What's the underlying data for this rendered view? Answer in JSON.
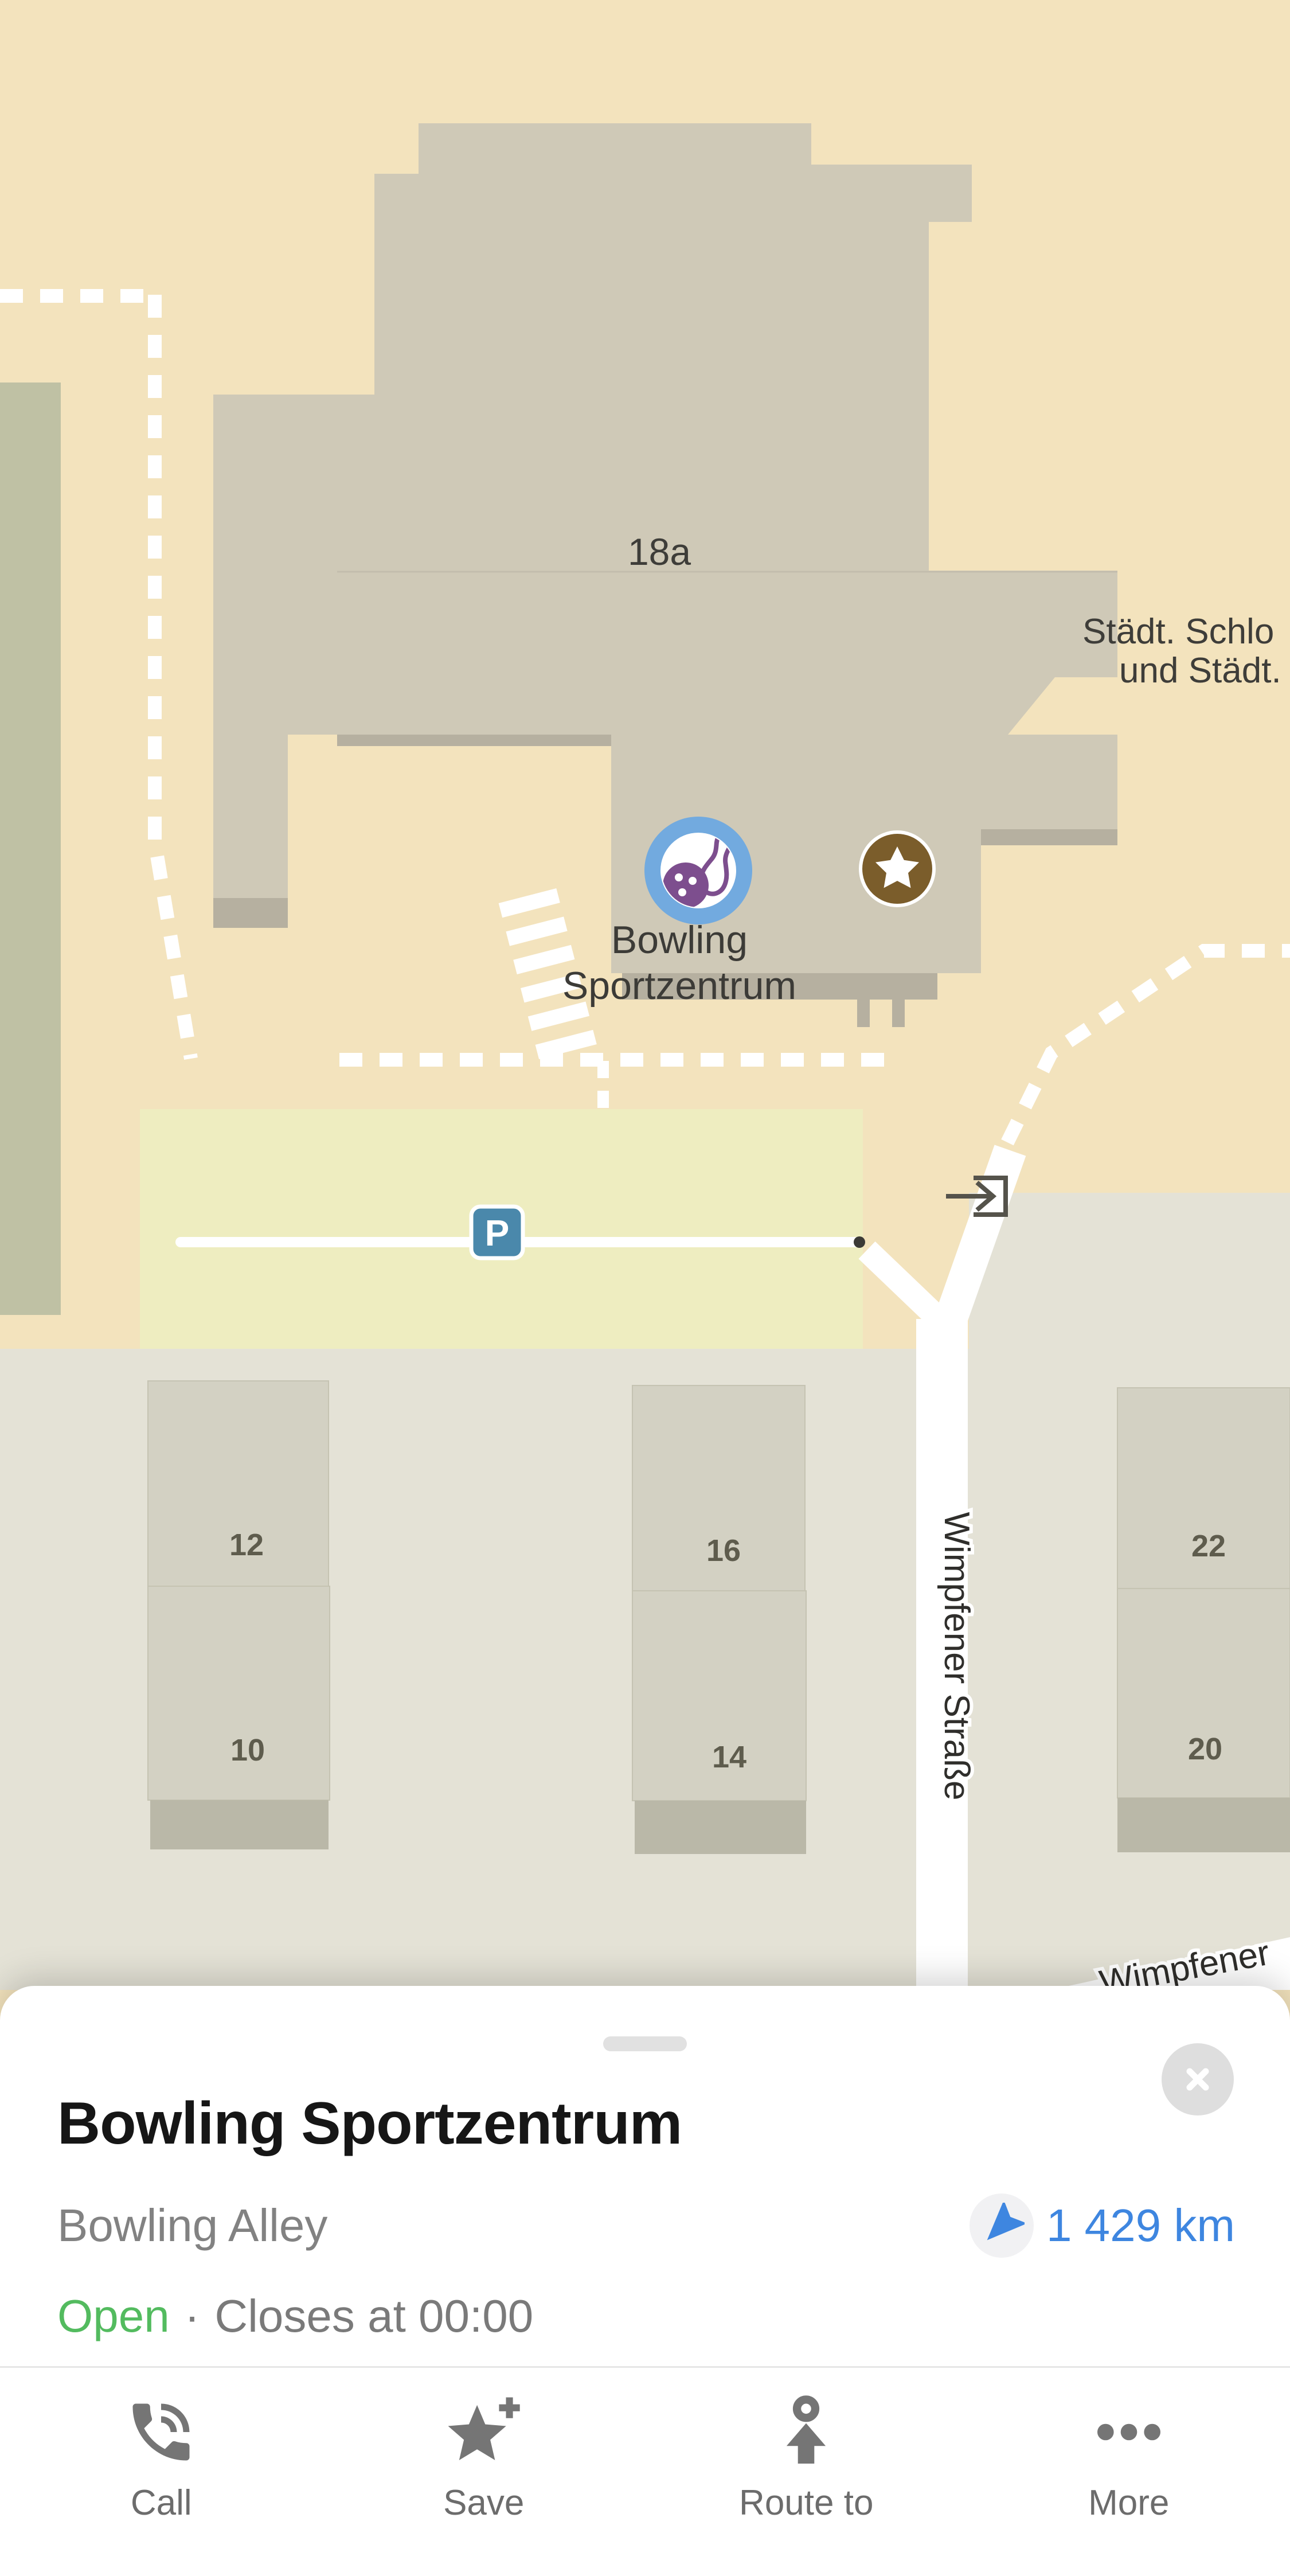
{
  "map": {
    "labels": {
      "building_number": "18a",
      "cut_line1": "Städt. Schlo",
      "cut_line2": "und Städt.",
      "poi_line1": "Bowling",
      "poi_line2": "Sportzentrum",
      "street_vertical": "Wimpfener Straße",
      "street_bottom": "Wimpfener",
      "parking": "P",
      "houses": [
        "12",
        "10",
        "16",
        "14",
        "22",
        "20"
      ]
    }
  },
  "sheet": {
    "title": "Bowling Sportzentrum",
    "category": "Bowling Alley",
    "distance": "1 429 km",
    "status_open": "Open",
    "status_separator": "·",
    "status_closes": "Closes at 00:00",
    "actions": [
      {
        "label": "Call"
      },
      {
        "label": "Save"
      },
      {
        "label": "Route to"
      },
      {
        "label": "More"
      }
    ]
  },
  "colors": {
    "map_land": "#F3E3BD",
    "map_lower": "#E4E2D6",
    "map_green": "#BFC1A4",
    "building": "#CFC9B7",
    "building_shadow": "#B6B0A0",
    "parking_area": "#EEEDC0",
    "house": "#D3D1C3",
    "house_base": "#BAB8A8",
    "poi_blue": "#72AADF",
    "poi_purple": "#7D4E8E",
    "star_brown": "#7B5D2B",
    "parking_badge": "#4A88AB",
    "accent_blue": "#3E86E0",
    "open_green": "#53BB5F",
    "icon_gray": "#757575"
  }
}
